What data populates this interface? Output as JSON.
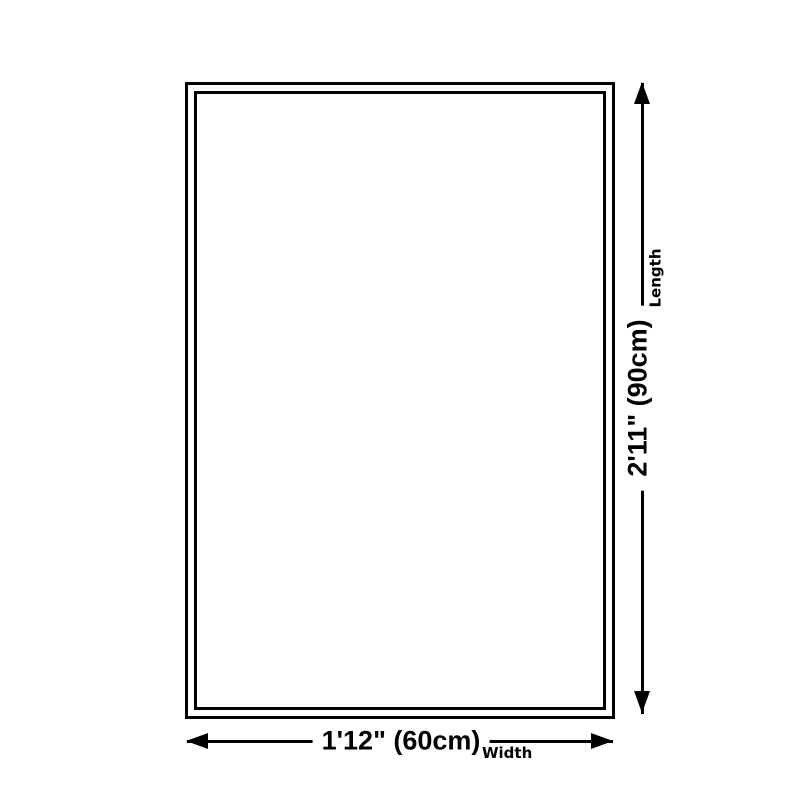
{
  "diagram": {
    "background_color": "#ffffff",
    "line_color": "#000000",
    "shape": "rectangle-with-double-border",
    "width_annotation": {
      "value": "1'12\" (60cm)",
      "label": "Width"
    },
    "length_annotation": {
      "value": "2'11\" (90cm)",
      "label": "Length"
    }
  }
}
